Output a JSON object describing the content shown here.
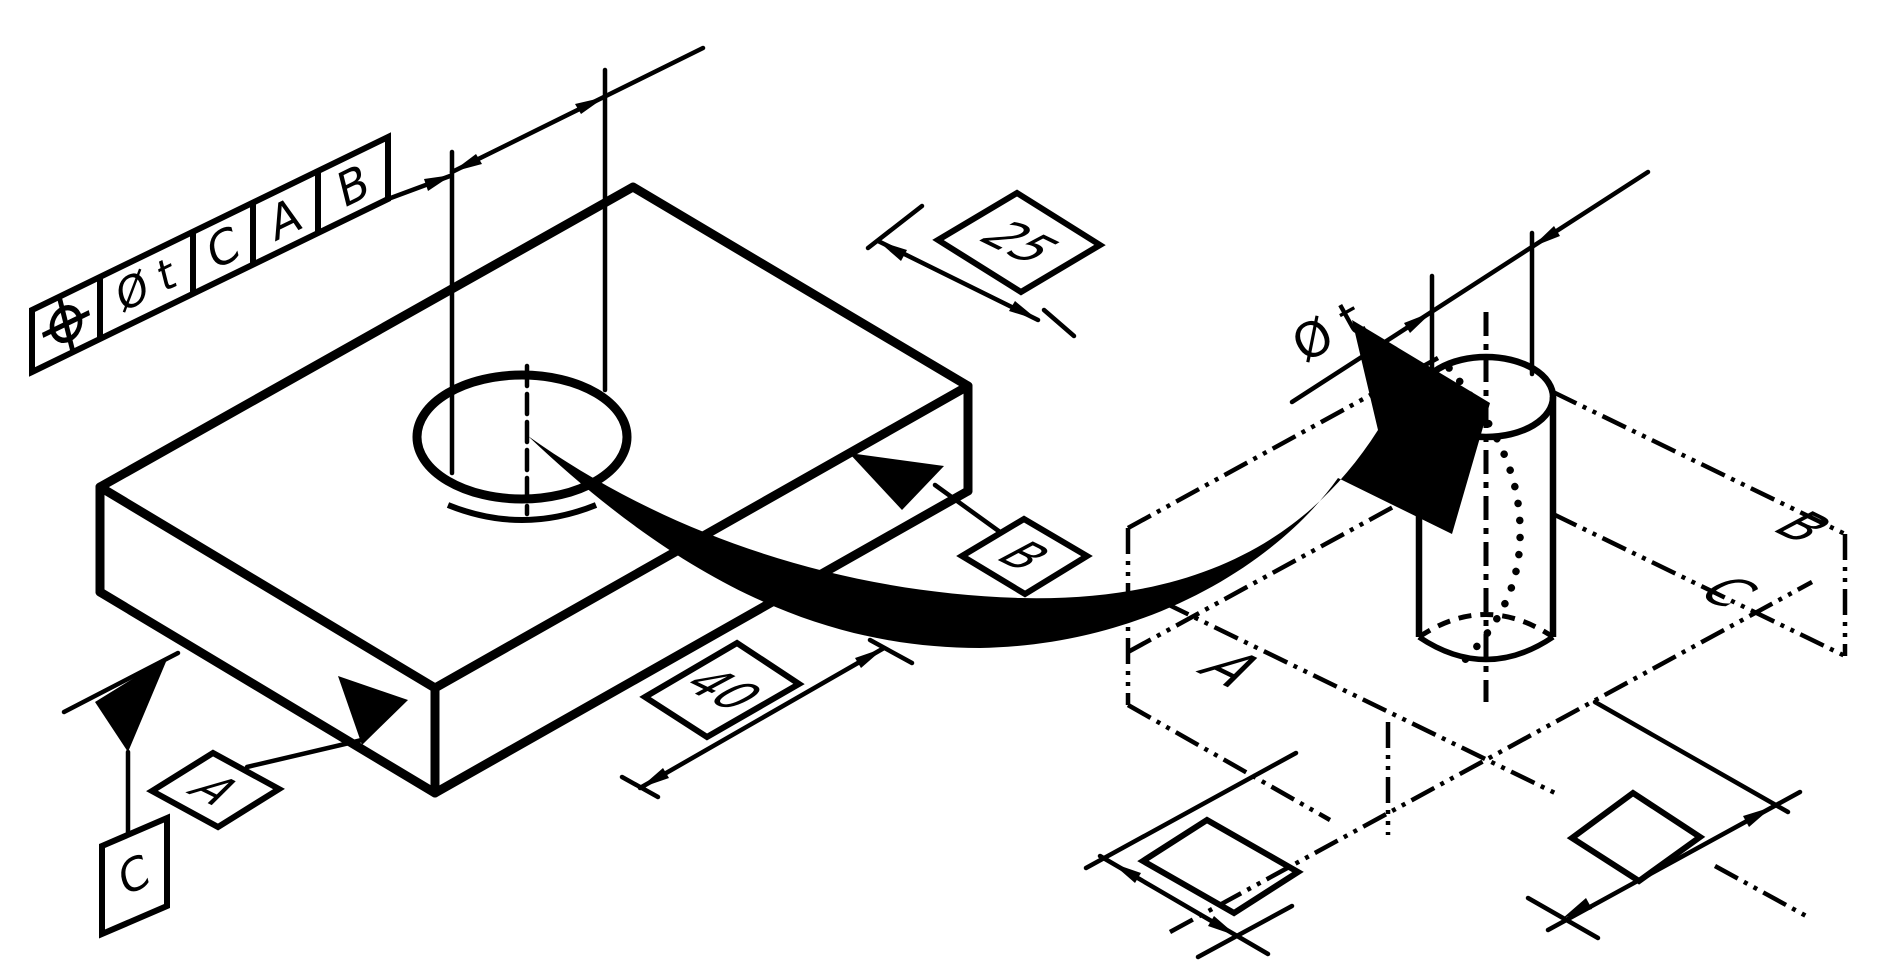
{
  "figure": {
    "title": "position-tolerance-of-a-hole-with-cylindrical-tolerance-zone",
    "fcf": {
      "position_symbol": "⌖",
      "tolerance": "Ø t",
      "datums": [
        "C",
        "A",
        "B"
      ]
    },
    "dims": {
      "basic_25": "25",
      "basic_40": "40"
    },
    "datums": {
      "a": "A",
      "b": "B",
      "c": "C"
    },
    "zone": {
      "diameter": "Ø t",
      "plane_a": "A",
      "plane_b": "B",
      "plane_c": "C"
    }
  },
  "colors": {
    "ink": "#000000",
    "paper": "#ffffff"
  }
}
